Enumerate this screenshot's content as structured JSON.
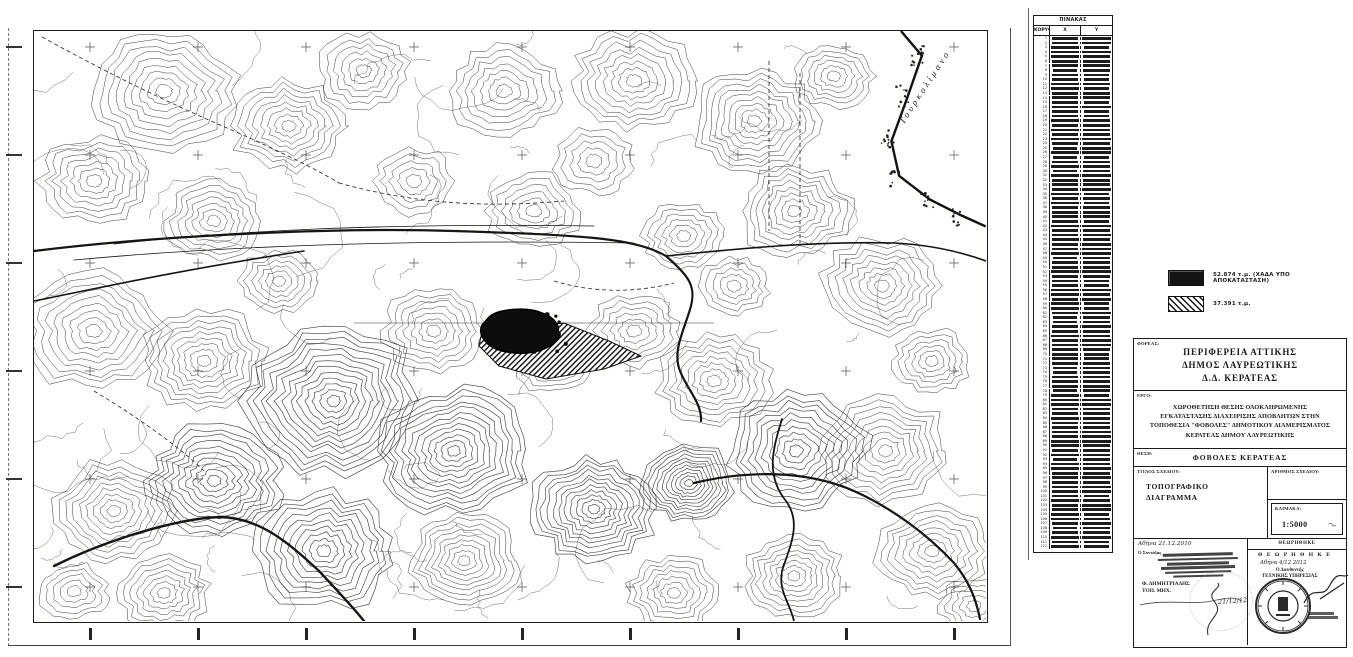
{
  "coord_table": {
    "title": "ΠΙΝΑΚΑΣ ΣΥΝΤΕΤΑΓΜΕΝΩΝ",
    "columns": [
      "ΚΟΡΥΦΗ",
      "Χ",
      "Υ"
    ],
    "row_count": 112
  },
  "legend": {
    "items": [
      {
        "swatch": "solid-black",
        "label": "52.874 τ.μ. (ΧΑΔΑ ΥΠΟ ΑΠΟΚΑΤΑΣΤΑΣΗ)"
      },
      {
        "swatch": "diagonal-hatch",
        "label": "37.391 τ.μ."
      }
    ]
  },
  "map": {
    "sea_label": "Τουρκολίμανο"
  },
  "title_block": {
    "forea_label": "ΦΟΡΕΑΣ:",
    "forea_lines": [
      "ΠΕΡΙΦΕΡΕΙΑ ΑΤΤΙΚΗΣ",
      "ΔΗΜΟΣ ΛΑΥΡΕΩΤΙΚΗΣ",
      "Δ.Δ. ΚΕΡΑΤΕΑΣ"
    ],
    "ergo_label": "ΕΡΓΟ:",
    "ergo_lines": [
      "ΧΩΡΟΘΕΤΗΣΗ ΘΕΣΗΣ ΟΛΟΚΛΗΡΩΜΕΝΗΣ",
      "ΕΓΚΑΤΑΣΤΑΣΗΣ ΔΙΑΧΕΙΡΙΣΗΣ ΑΠΟΒΛΗΤΩΝ ΣΤΗΝ",
      "ΤΟΠΟΘΕΣΙΑ \"ΦΟΒΟΛΕΣ\" ΔΗΜΟΤΙΚΟΥ ΔΙΑΜΕΡΙΣΜΑΤΟΣ",
      "ΚΕΡΑΤΕΑΣ ΔΗΜΟΥ ΛΑΥΡΕΩΤΙΚΗΣ"
    ],
    "thesi_label": "ΘΕΣΗ:",
    "thesi_value": "ΦΟΒΟΛΕΣ ΚΕΡΑΤΕΑΣ",
    "titlos_label": "ΤΙΤΛΟΣ ΣΧΕΔΙΟΥ:",
    "titlos_value": "ΤΟΠΟΓΡΑΦΙΚΟ\nΔΙΑΓΡΑΜΜΑ",
    "arithmos_label": "ΑΡΙΘΜΟΣ ΣΧΕΔΙΟΥ:",
    "klimaka_label": "ΚΛΙΜΑΚΑ:",
    "klimaka_value": "1:5000",
    "date_line": "Αθήνα 21.12.2010",
    "syntaxas_label": "Ο Συντάξας",
    "author_name": "Φ. ΔΗΜΗΤΡΙΑΔΗΣ",
    "author_title": "ΤΟΠ. ΜΗΧ.",
    "handwritten_date": "21/12/12",
    "theorithike_header": "ΘΕΩΡΗΘΗΚΕ",
    "theorithike_stamp": "Θ Ε Ω Ρ Η Θ Η Κ Ε",
    "approval_date_line": "Αθήνα 4/12 2012",
    "approval_role_line1": "Ο Διευθυντής",
    "approval_role_line2": "ΤΕΧΝΙΚΗΣ ΥΠΗΡΕΣΙΑΣ"
  },
  "colors": {
    "ink": "#1c1c1c",
    "paper": "#ffffff"
  }
}
